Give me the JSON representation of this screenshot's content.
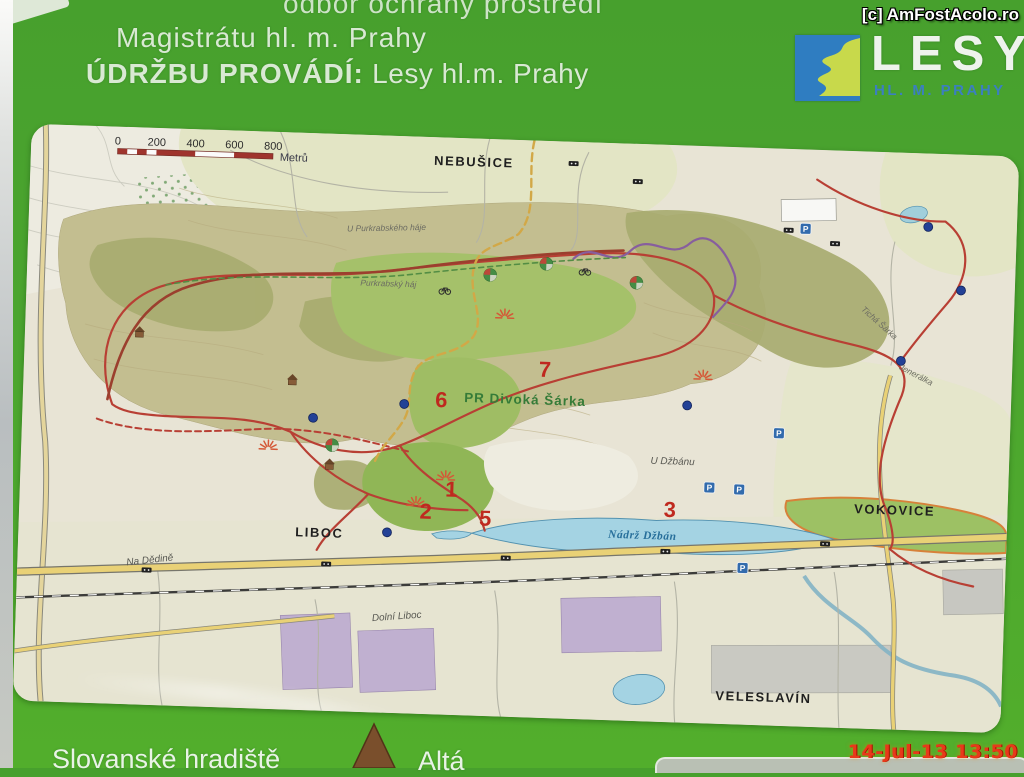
{
  "header": {
    "line1_partial": "odbor ochrany prostředí",
    "line2": "Magistrátu hl. m. Prahy",
    "line3_label": "ÚDRŽBU PROVÁDÍ:",
    "line3_value": " Lesy hl.m. Prahy"
  },
  "watermark": "[c] AmFostAcolo.ro",
  "logo": {
    "title": "LESY",
    "subtitle": "HL. M. PRAHY"
  },
  "map": {
    "scale_bar": {
      "ticks": [
        "0",
        "200",
        "400",
        "600",
        "800"
      ],
      "unit": "Metrů"
    },
    "labels": {
      "nebusice": "NEBUŠICE",
      "u_purkrabskeho_haje": "U Purkrabského háje",
      "purkrabsky_haj": "Purkrabský háj",
      "pr_divoka_sarka": "PR Divoká Šárka",
      "ticha_sarka": "Tichá Šárka",
      "jeneralka": "Jenerálka",
      "nadrz_dzban": "Nádrž Džbán",
      "u_dzbanu": "U Džbánu",
      "vokovice": "VOKOVICE",
      "liboc": "LIBOC",
      "na_dedine": "Na Dědině",
      "dolni_liboc": "Dolní Liboc",
      "veleslavin": "VELESLAVÍN"
    },
    "route_numbers": [
      {
        "label": "1"
      },
      {
        "label": "2"
      },
      {
        "label": "3"
      },
      {
        "label": "5"
      },
      {
        "label": "6"
      },
      {
        "label": "7"
      }
    ],
    "parking_symbol": "P",
    "symbols": {
      "viewpoint": "red-sunburst",
      "shelter": "brown-hut",
      "spring": "blue-dot",
      "playground": "colored-orb",
      "bus_stop": "black-stop",
      "cycling": "bicycle"
    }
  },
  "legend": {
    "item_hradiste": "Slovanské hradiště",
    "item_altan_partial": "Altá"
  },
  "timestamp": "14-Jul-13 13:50",
  "colors": {
    "board_green": "#4ba52f",
    "map_cream": "#ece8d8",
    "lake_blue": "#a2d6e8",
    "trail_red": "#c23b2e",
    "meadow_green": "#a5c463",
    "logo_blue": "#2f7dc1",
    "logo_lime": "#c8d94b",
    "timestamp_red": "#e8391a"
  }
}
